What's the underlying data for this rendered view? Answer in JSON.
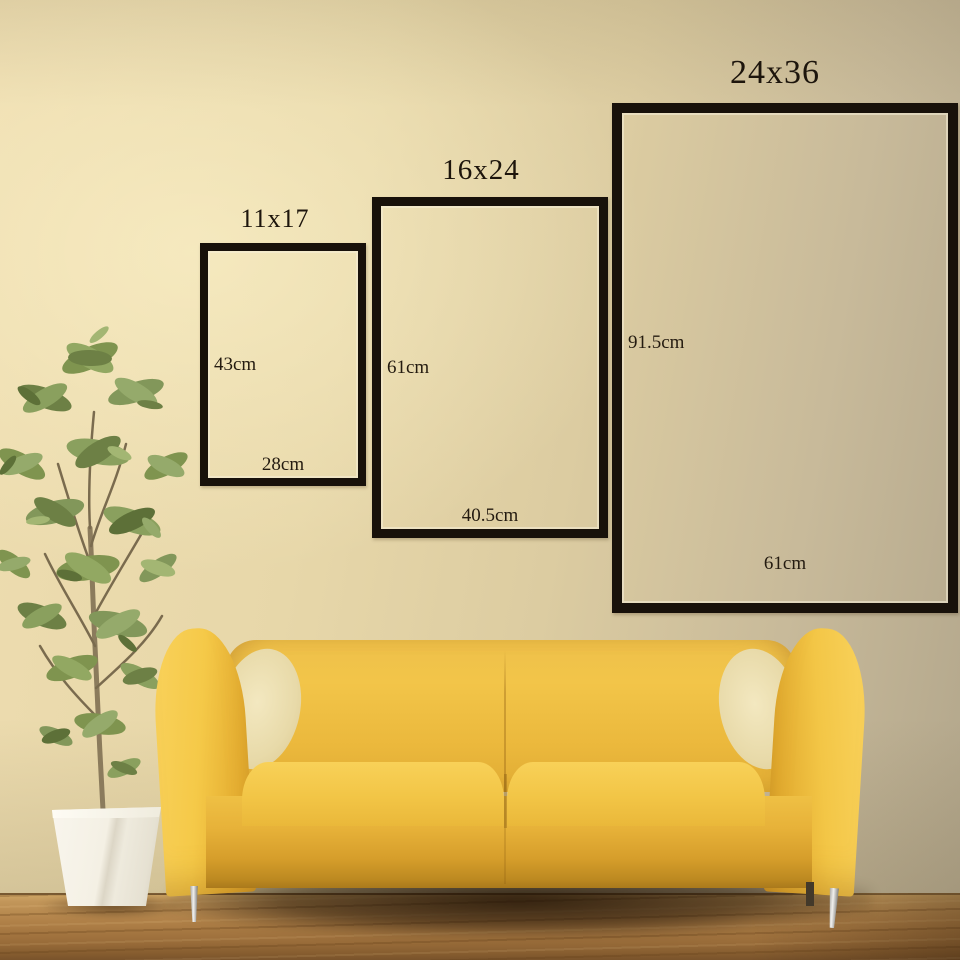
{
  "frames": [
    {
      "title": "11x17",
      "height_label": "43cm",
      "width_label": "28cm"
    },
    {
      "title": "16x24",
      "height_label": "61cm",
      "width_label": "40.5cm"
    },
    {
      "title": "24x36",
      "height_label": "91.5cm",
      "width_label": "61cm"
    }
  ],
  "colors": {
    "wall_light": "#eeddb0",
    "wall_dark": "#b3a78c",
    "frame_border": "#18110a",
    "label_text": "#241b10",
    "sofa_yellow": "#f2c546",
    "sofa_shade": "#aa791c",
    "floor_wood": "#b08148",
    "plant_green": "#82975a",
    "pot_white": "#f6f3ea"
  }
}
